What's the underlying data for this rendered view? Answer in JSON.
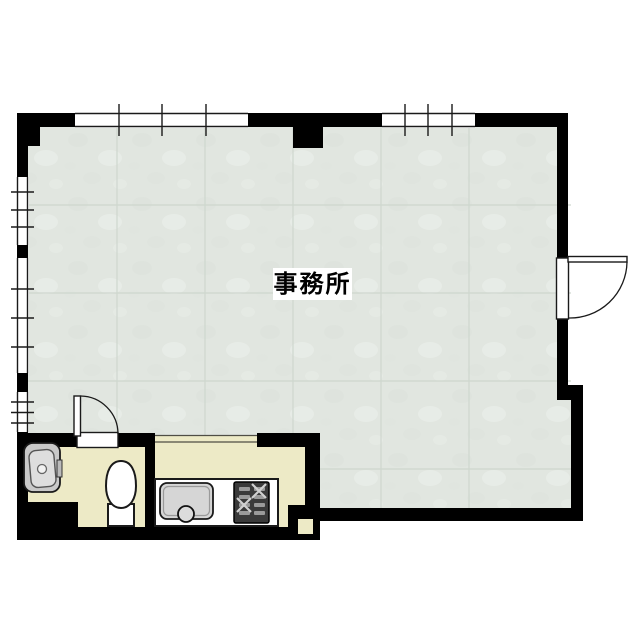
{
  "floorplan": {
    "room_label": "事務所",
    "colors": {
      "page_bg": "#ffffff",
      "wall": "#000000",
      "line": "#1a1a1a",
      "main_floor": "#e1e6e0",
      "main_floor_seam": "#ccd5cc",
      "service_floor": "#edeac6",
      "fixture_fill": "#ffffff",
      "sink_gray": "#d6d6d6",
      "basin_gray": "#c9c9c9",
      "stove_dark": "#3a3a3a",
      "stove_detail": "#9a9a9a",
      "label_bg": "#ffffff",
      "label_text": "#000000"
    },
    "fixtures": {
      "toilet": "toilet",
      "wash_basin": "wash-basin",
      "kitchen_sink": "kitchen-sink",
      "stove": "gas-stove",
      "kitchen_counter": "kitchen-counter"
    },
    "openings": {
      "entrance_door": "hinged-door-right-wall",
      "bathroom_door": "hinged-door-bathroom",
      "windows_top": 2,
      "windows_left": 3
    }
  }
}
